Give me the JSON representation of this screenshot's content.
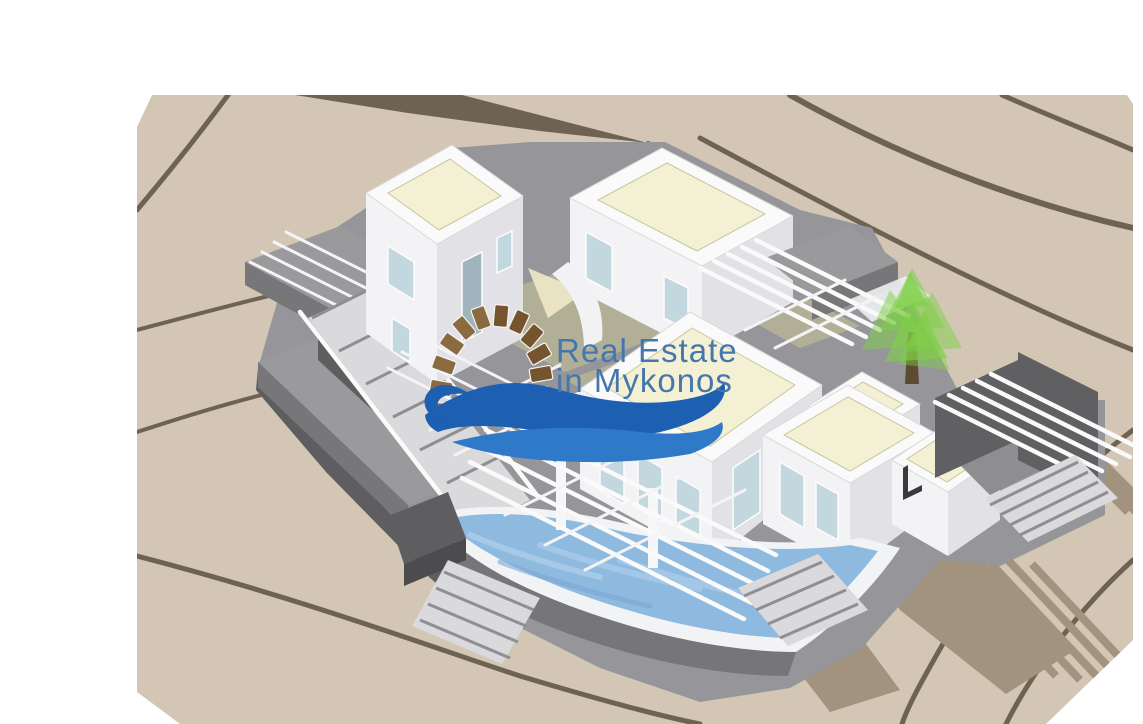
{
  "watermark": {
    "line1": "Real Estate",
    "line2": "in Mykonos",
    "text_color": "#4577ad",
    "wave_color_dark": "#1d5fb0",
    "wave_color_light": "#2f7ac8",
    "arch_stone_color": "#8a6a3f",
    "arch_stone_color_alt": "#76552e"
  },
  "palette": {
    "page_background": "#ffffff",
    "terrain": "#d3c6b5",
    "contour_line": "#6e6353",
    "building_wall_light": "#f3f3f5",
    "building_wall_shade": "#e2e2e6",
    "roof_cream": "#f4f0d3",
    "courtyard_olive": "#b1b097",
    "terrace_gray": "#96969a",
    "wall_dark_gray": "#606062",
    "pool_water": "#8fbadf",
    "pool_highlight": "#a9cbe8",
    "shadow": "#a2937e",
    "tree_green": "#7ed046",
    "tree_trunk": "#5c4a33"
  }
}
